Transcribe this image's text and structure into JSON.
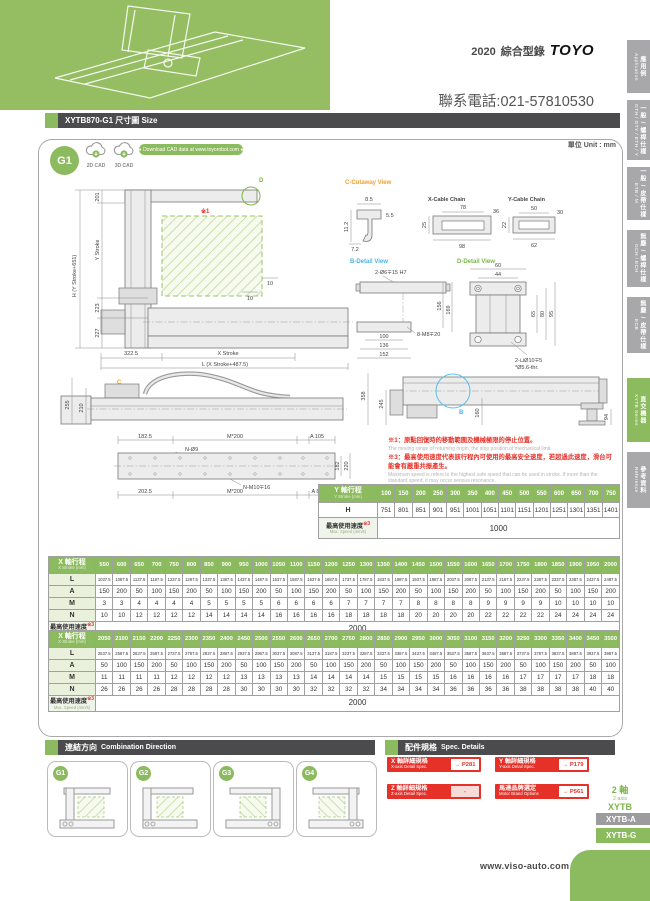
{
  "header": {
    "year": "2020",
    "catalog": "綜合型錄",
    "brand": "TOYO",
    "phone": "聯系電話:021-57810530"
  },
  "sidebar": {
    "tabs": [
      {
        "zh": "應用例",
        "en": "Application"
      },
      {
        "zh": "一般 / 螺桿仕樣",
        "en": "GTH / GTY / ETH / Y"
      },
      {
        "zh": "一般 / 皮帶仕樣",
        "en": "ETB / M"
      },
      {
        "zh": "無塵 / 螺桿仕樣",
        "en": "GCH / ECH"
      },
      {
        "zh": "無塵 / 皮帶仕樣",
        "en": "ECB"
      },
      {
        "zh": "直交機器",
        "en": "XYTB Series"
      },
      {
        "zh": "參考資料",
        "en": "Reference"
      }
    ]
  },
  "title_bar": {
    "title": "XYTB870-G1 尺寸圖 Size"
  },
  "cad": {
    "badge": "G1",
    "cad2d": "2D CAD",
    "cad3d": "3D CAD",
    "download": "● Download CAD data at www.toyorobot.com ●",
    "unit": "單位 Unit : mm"
  },
  "drawing": {
    "front": {
      "callout": "D",
      "note": "※1",
      "d201": "201",
      "ystroke": "Y Stroke",
      "h": "H (Y Stroke+651)",
      "d10a": "10",
      "d10b": "10",
      "d223": "223",
      "d227": "227",
      "d3225": "322.5",
      "xstroke": "X Stroke",
      "l": "L (X Stroke+487.5)"
    },
    "cutaway": {
      "title": "C-Cutaway View",
      "d85": "8.5",
      "d55": "5.5",
      "d112": "11.2",
      "d72": "7.2"
    },
    "xchain": {
      "title": "X-Cable Chain",
      "d78": "78",
      "d36": "36",
      "d25": "25",
      "d98": "98"
    },
    "ychain": {
      "title": "Y-Cable Chain",
      "d50": "50",
      "d30": "30",
      "d22": "22",
      "d62": "62"
    },
    "bdetail": {
      "title": "B-Detail View",
      "hole": "2-Ø6∓15 H7",
      "d156": "156",
      "d169": "169",
      "d100": "100",
      "d136": "136",
      "d152": "152",
      "tap": "8-M8∓20"
    },
    "ddetail": {
      "title": "D-Detail View",
      "d60": "60",
      "d44": "44",
      "d65": "65",
      "d80": "80",
      "d95": "95",
      "hole1": "2-⊔Ø10∓5",
      "hole2": "*Ø5.6-thr."
    },
    "side": {
      "callout": "C",
      "d255": "255",
      "d210": "210"
    },
    "top": {
      "d1825": "182.5",
      "m200a": "M*200",
      "a105": "A 105",
      "nhole": "N-Ø9",
      "d182": "182",
      "d220": "220",
      "ntap": "N-M10∓16",
      "d2025": "202.5",
      "m200b": "M*200",
      "a85": "A 85"
    },
    "right": {
      "callout": "B",
      "d358": "358",
      "d245": "245",
      "d160": "160",
      "d94": "94"
    }
  },
  "notes": {
    "n1_zh": "※1：原點回復時的移動範圍及機械極限的停止位置。",
    "n1_en": "The moving range of returning origin, the stop position of mechanical limit.",
    "n3_zh": "※3：最高使用速度代表該行程內可使用的最高安全速度，若超過此速度，滑台可能會有嚴重共振產生。",
    "n3_en": "Maximum speed is refers to the highest safe speed that can be used in stroke. If more than the standard speed, it may occur serious resonance."
  },
  "tables": {
    "y": {
      "label": "Y 軸行程",
      "label_en": "Y Stroke (mm)",
      "columns": [
        "100",
        "150",
        "200",
        "250",
        "300",
        "350",
        "400",
        "450",
        "500",
        "550",
        "600",
        "650",
        "700",
        "750"
      ],
      "rows": [
        {
          "label": "H",
          "values": [
            "751",
            "801",
            "851",
            "901",
            "951",
            "1001",
            "1051",
            "1101",
            "1151",
            "1201",
            "1251",
            "1301",
            "1351",
            "1401"
          ]
        }
      ],
      "footer": {
        "label": "最高使用速度",
        "mark": "※3",
        "label_en": "Max. Speed (mm/s)",
        "value": "1000"
      }
    },
    "x1": {
      "label": "X 軸行程",
      "label_en": "X Stroke (mm)",
      "columns": [
        "550",
        "600",
        "650",
        "700",
        "750",
        "800",
        "850",
        "900",
        "950",
        "1000",
        "1050",
        "1100",
        "1150",
        "1200",
        "1250",
        "1300",
        "1350",
        "1400",
        "1450",
        "1500",
        "1550",
        "1600",
        "1650",
        "1700",
        "1750",
        "1800",
        "1850",
        "1900",
        "1950",
        "2000"
      ],
      "rows": [
        {
          "label": "L",
          "small": true,
          "values": [
            "1037.5",
            "1087.5",
            "1137.5",
            "1187.5",
            "1237.5",
            "1287.5",
            "1337.5",
            "1387.5",
            "1437.5",
            "1487.5",
            "1537.5",
            "1587.5",
            "1637.5",
            "1687.5",
            "1737.5",
            "1787.5",
            "1837.5",
            "1887.5",
            "1937.5",
            "1987.5",
            "2037.5",
            "2087.5",
            "2137.5",
            "2187.5",
            "2237.5",
            "2287.5",
            "2337.5",
            "2387.5",
            "2437.5",
            "2487.5"
          ]
        },
        {
          "label": "A",
          "values": [
            "150",
            "200",
            "50",
            "100",
            "150",
            "200",
            "50",
            "100",
            "150",
            "200",
            "50",
            "100",
            "150",
            "200",
            "50",
            "100",
            "150",
            "200",
            "50",
            "100",
            "150",
            "200",
            "50",
            "100",
            "150",
            "200",
            "50",
            "100",
            "150",
            "200"
          ]
        },
        {
          "label": "M",
          "values": [
            "3",
            "3",
            "4",
            "4",
            "4",
            "4",
            "5",
            "5",
            "5",
            "5",
            "6",
            "6",
            "6",
            "6",
            "7",
            "7",
            "7",
            "7",
            "8",
            "8",
            "8",
            "8",
            "9",
            "9",
            "9",
            "9",
            "10",
            "10",
            "10",
            "10"
          ]
        },
        {
          "label": "N",
          "values": [
            "10",
            "10",
            "12",
            "12",
            "12",
            "12",
            "14",
            "14",
            "14",
            "14",
            "16",
            "16",
            "16",
            "16",
            "18",
            "18",
            "18",
            "18",
            "20",
            "20",
            "20",
            "20",
            "22",
            "22",
            "22",
            "22",
            "24",
            "24",
            "24",
            "24"
          ]
        }
      ],
      "footer": {
        "label": "最高使用速度",
        "mark": "※3",
        "label_en": "Max. Speed (mm/s)",
        "value": "2000"
      }
    },
    "x2": {
      "label": "X 軸行程",
      "label_en": "X Stroke (mm)",
      "columns": [
        "2050",
        "2100",
        "2150",
        "2200",
        "2250",
        "2300",
        "2350",
        "2400",
        "2450",
        "2500",
        "2550",
        "2600",
        "2650",
        "2700",
        "2750",
        "2800",
        "2850",
        "2900",
        "2950",
        "3000",
        "3050",
        "3100",
        "3150",
        "3200",
        "3250",
        "3300",
        "3350",
        "3400",
        "3450",
        "3500"
      ],
      "rows": [
        {
          "label": "L",
          "small": true,
          "values": [
            "2537.5",
            "2587.5",
            "2637.5",
            "2687.5",
            "2737.5",
            "2787.5",
            "2837.5",
            "2887.5",
            "2937.5",
            "2987.5",
            "3037.5",
            "3087.5",
            "3137.5",
            "3187.5",
            "3237.5",
            "3287.5",
            "3337.5",
            "3387.5",
            "3437.5",
            "3487.5",
            "3537.5",
            "3587.5",
            "3637.5",
            "3687.5",
            "3737.5",
            "3787.5",
            "3837.5",
            "3887.5",
            "3937.5",
            "3987.5"
          ]
        },
        {
          "label": "A",
          "values": [
            "50",
            "100",
            "150",
            "200",
            "50",
            "100",
            "150",
            "200",
            "50",
            "100",
            "150",
            "200",
            "50",
            "100",
            "150",
            "200",
            "50",
            "100",
            "150",
            "200",
            "50",
            "100",
            "150",
            "200",
            "50",
            "100",
            "150",
            "200",
            "50",
            "100"
          ]
        },
        {
          "label": "M",
          "values": [
            "11",
            "11",
            "11",
            "11",
            "12",
            "12",
            "12",
            "12",
            "13",
            "13",
            "13",
            "13",
            "14",
            "14",
            "14",
            "14",
            "15",
            "15",
            "15",
            "15",
            "16",
            "16",
            "16",
            "16",
            "17",
            "17",
            "17",
            "17",
            "18",
            "18"
          ]
        },
        {
          "label": "N",
          "values": [
            "26",
            "26",
            "26",
            "26",
            "28",
            "28",
            "28",
            "28",
            "30",
            "30",
            "30",
            "30",
            "32",
            "32",
            "32",
            "32",
            "34",
            "34",
            "34",
            "34",
            "36",
            "36",
            "36",
            "36",
            "38",
            "38",
            "38",
            "38",
            "40",
            "40"
          ]
        }
      ],
      "footer": {
        "label": "最高使用速度",
        "mark": "※3",
        "label_en": "Max. Speed (mm/s)",
        "value": "2000"
      }
    }
  },
  "combo": {
    "title_zh": "連結方向",
    "title_en": "Combination Direction",
    "items": [
      {
        "label": "G1"
      },
      {
        "label": "G2"
      },
      {
        "label": "G3"
      },
      {
        "label": "G4"
      }
    ]
  },
  "spec": {
    "title_zh": "配件規格",
    "title_en": "Spec. Details",
    "items": [
      {
        "zh": "X 軸詳細規格",
        "en": "X-axis Detail Spec.",
        "page": "→ P281"
      },
      {
        "zh": "Y 軸詳細規格",
        "en": "Y-axis Detail Spec.",
        "page": "→ P179"
      },
      {
        "zh": "Z 軸詳細規格",
        "en": "Z-axis Detail Spec.",
        "page": "-"
      },
      {
        "zh": "馬達品牌選定",
        "en": "Motor Brand Options",
        "page": "→ P561"
      }
    ]
  },
  "axis_group": {
    "axes_zh": "2 軸",
    "axes_en": "2 axis",
    "series": "XYTB",
    "tabs": [
      {
        "label": "XYTB-A"
      },
      {
        "label": "XYTB-G"
      }
    ]
  },
  "footer": {
    "url": "www.viso-auto.com"
  }
}
